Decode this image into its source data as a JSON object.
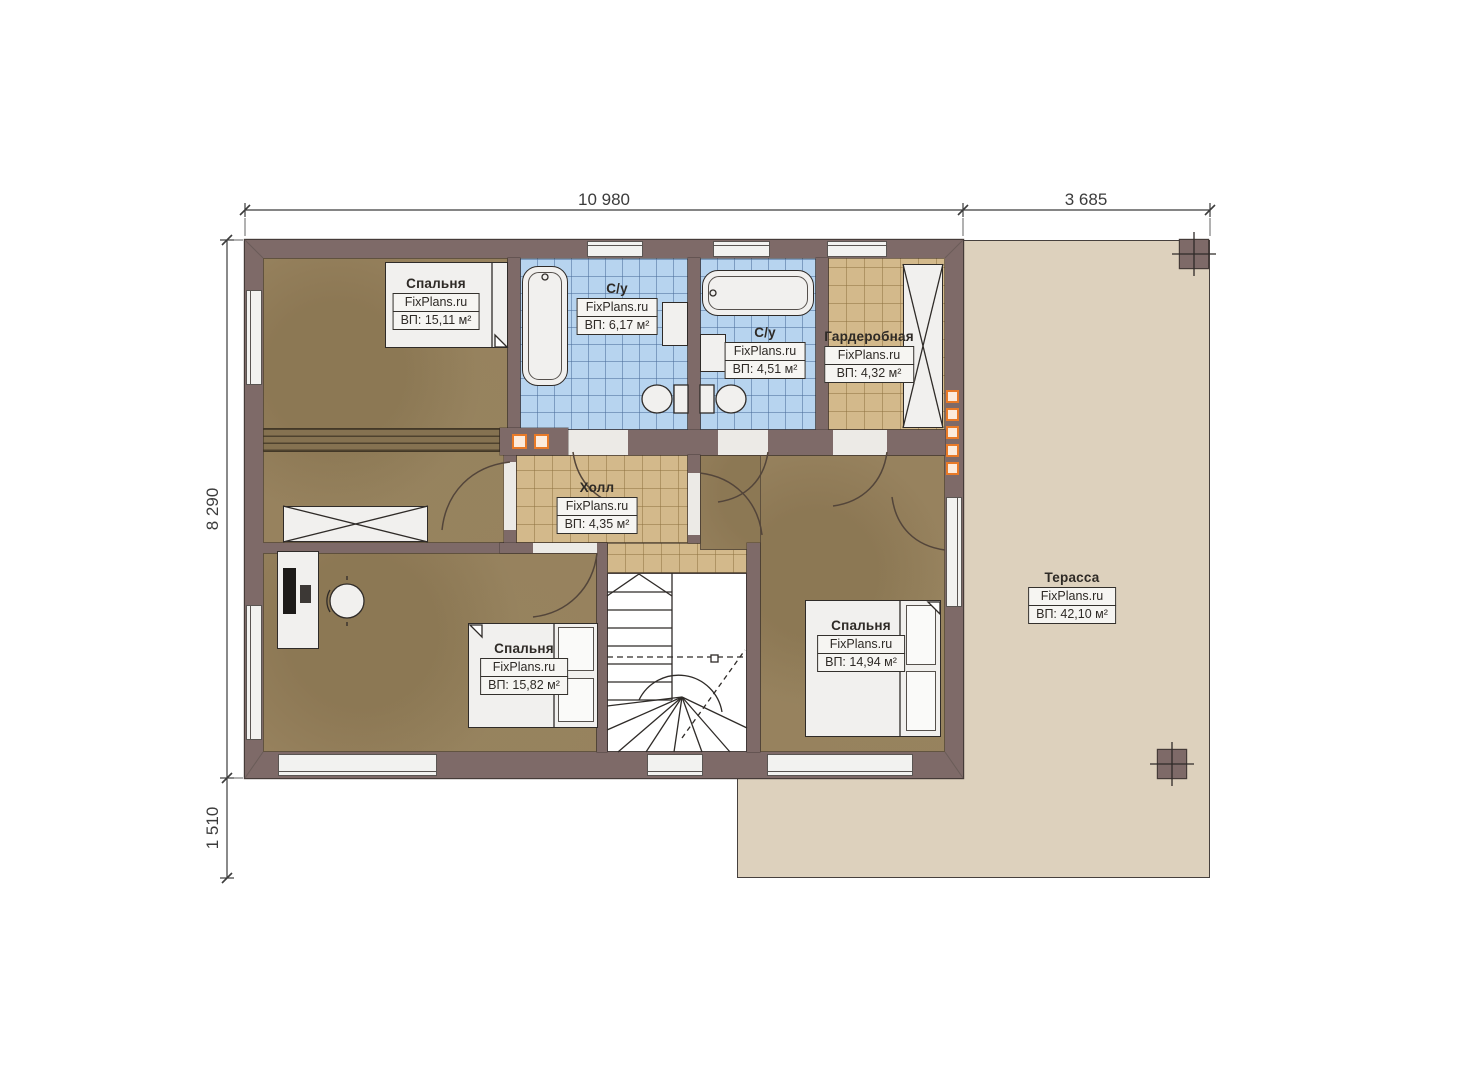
{
  "plan_title": "floor plan, second storey",
  "brand": "FixPlans.ru",
  "dimensions": {
    "top_main": "10 980",
    "top_terrace": "3 685",
    "left_main": "8 290",
    "left_lower": "1 510"
  },
  "rooms": [
    {
      "name": "Спальня",
      "area": "ВП: 15,11 м²"
    },
    {
      "name": "С/у",
      "area": "ВП: 6,17 м²"
    },
    {
      "name": "С/у",
      "area": "ВП: 4,51 м²"
    },
    {
      "name": "Гардеробная",
      "area": "ВП: 4,32 м²"
    },
    {
      "name": "Холл",
      "area": "ВП: 4,35 м²"
    },
    {
      "name": "Спальня",
      "area": "ВП: 15,82 м²"
    },
    {
      "name": "Спальня",
      "area": "ВП: 14,94 м²"
    },
    {
      "name": "Терасса",
      "area": "ВП: 42,10 м²"
    }
  ],
  "palette": {
    "wall": "#7e6a68",
    "wallLine": "#453b38",
    "floorBrown": "#97825e",
    "tileBlue": "#b7d4ef",
    "tileTan": "#d3b98b",
    "terrace": "#ddd1bd",
    "furniture": "#f1f0ee",
    "labelBg": "#f6f5f2",
    "text": "#2e2a26",
    "accentOrange": "#e87a28",
    "dimension": "#3c3c3c"
  }
}
